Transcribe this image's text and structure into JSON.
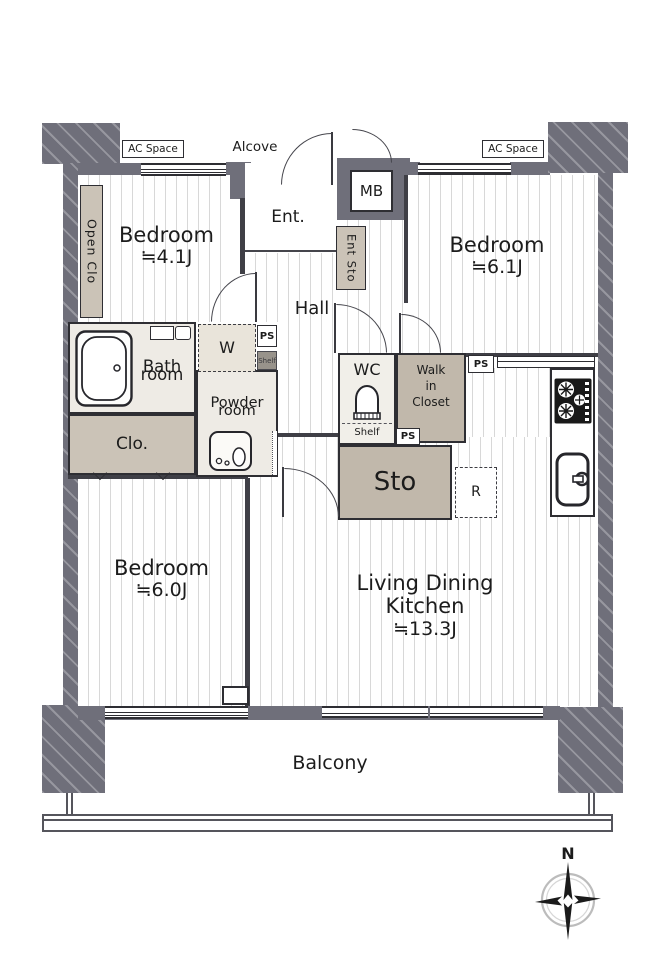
{
  "plan_type": "floor_plan",
  "labels": {
    "ac_space": "AC Space",
    "alcove": "Alcove",
    "mb": "MB",
    "ent": "Ent.",
    "ent_sto": "Ent Sto",
    "open_clo": "Open Clo",
    "hall": "Hall",
    "ps": "PS",
    "shelf": "Shelf",
    "w": "W",
    "r": "R",
    "balcony": "Balcony",
    "compass_north": "N"
  },
  "rooms": {
    "bedroom_nw": {
      "name": "Bedroom",
      "area": "≒4.1J"
    },
    "bedroom_ne": {
      "name": "Bedroom",
      "area": "≒6.1J"
    },
    "bedroom_sw": {
      "name": "Bedroom",
      "area": "≒6.0J"
    },
    "ldk": {
      "line1": "Living Dining",
      "line2": "Kitchen",
      "area": "≒13.3J"
    },
    "bath": {
      "line1": "Bath",
      "line2": "room"
    },
    "powder": {
      "line1": "Powder",
      "line2": "room"
    },
    "wc": {
      "name": "WC"
    },
    "closet": {
      "name": "Clo."
    },
    "walk_in_closet": {
      "line1": "Walk",
      "line2": "in",
      "line3": "Closet"
    },
    "storage": {
      "name": "Sto"
    }
  },
  "colors": {
    "outer_wall": "#6f6f7a",
    "inner_wall": "#3f3f46",
    "closet_fill_light": "#cbc3b7",
    "closet_fill_dark": "#c1b8ab",
    "wet_room_fill": "#eeebe5",
    "floor_stripe": "#d8d8d8",
    "shelf_fill": "#98938b"
  }
}
